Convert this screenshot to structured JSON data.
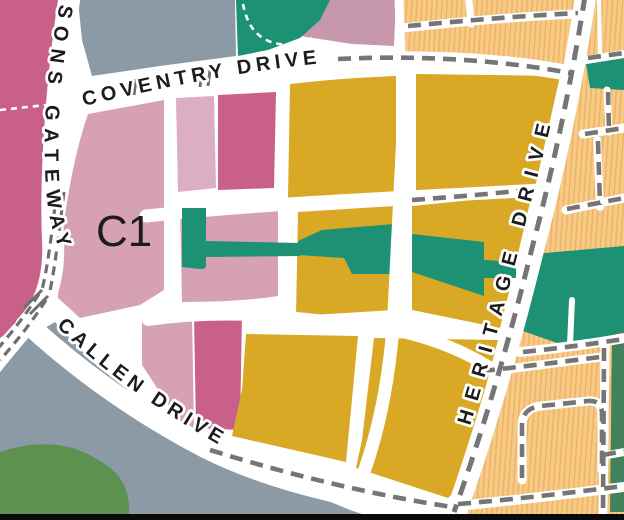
{
  "streets": {
    "parsons_gateway": "SONS GATEWAY",
    "coventry_drive": "COVENTRY DRIVE",
    "callen_drive": "CALLEN DRIVE",
    "heritage_drive": "HERITAGE DRIVE"
  },
  "zone_labels": {
    "c1": "C1"
  },
  "colors": {
    "road_white": "#ffffff",
    "road_dash_gray": "#757575",
    "road_dash_dark": "#6f6f6f",
    "zone_pink_dark": "#c9608a",
    "zone_pink_light": "#d7a1b5",
    "zone_pink_lighter": "#dcaec1",
    "zone_mauve": "#c797ab",
    "zone_gold": "#d9a824",
    "zone_teal": "#1d9173",
    "zone_orange": "#f8ca86",
    "zone_orange_hatch": "#eab468",
    "zone_gray_blue": "#8c9aa6",
    "zone_green": "#5c9150",
    "zone_green_dark": "#41825a",
    "label_text": "#1c1c1c",
    "map_border": "#0a0a0a"
  }
}
